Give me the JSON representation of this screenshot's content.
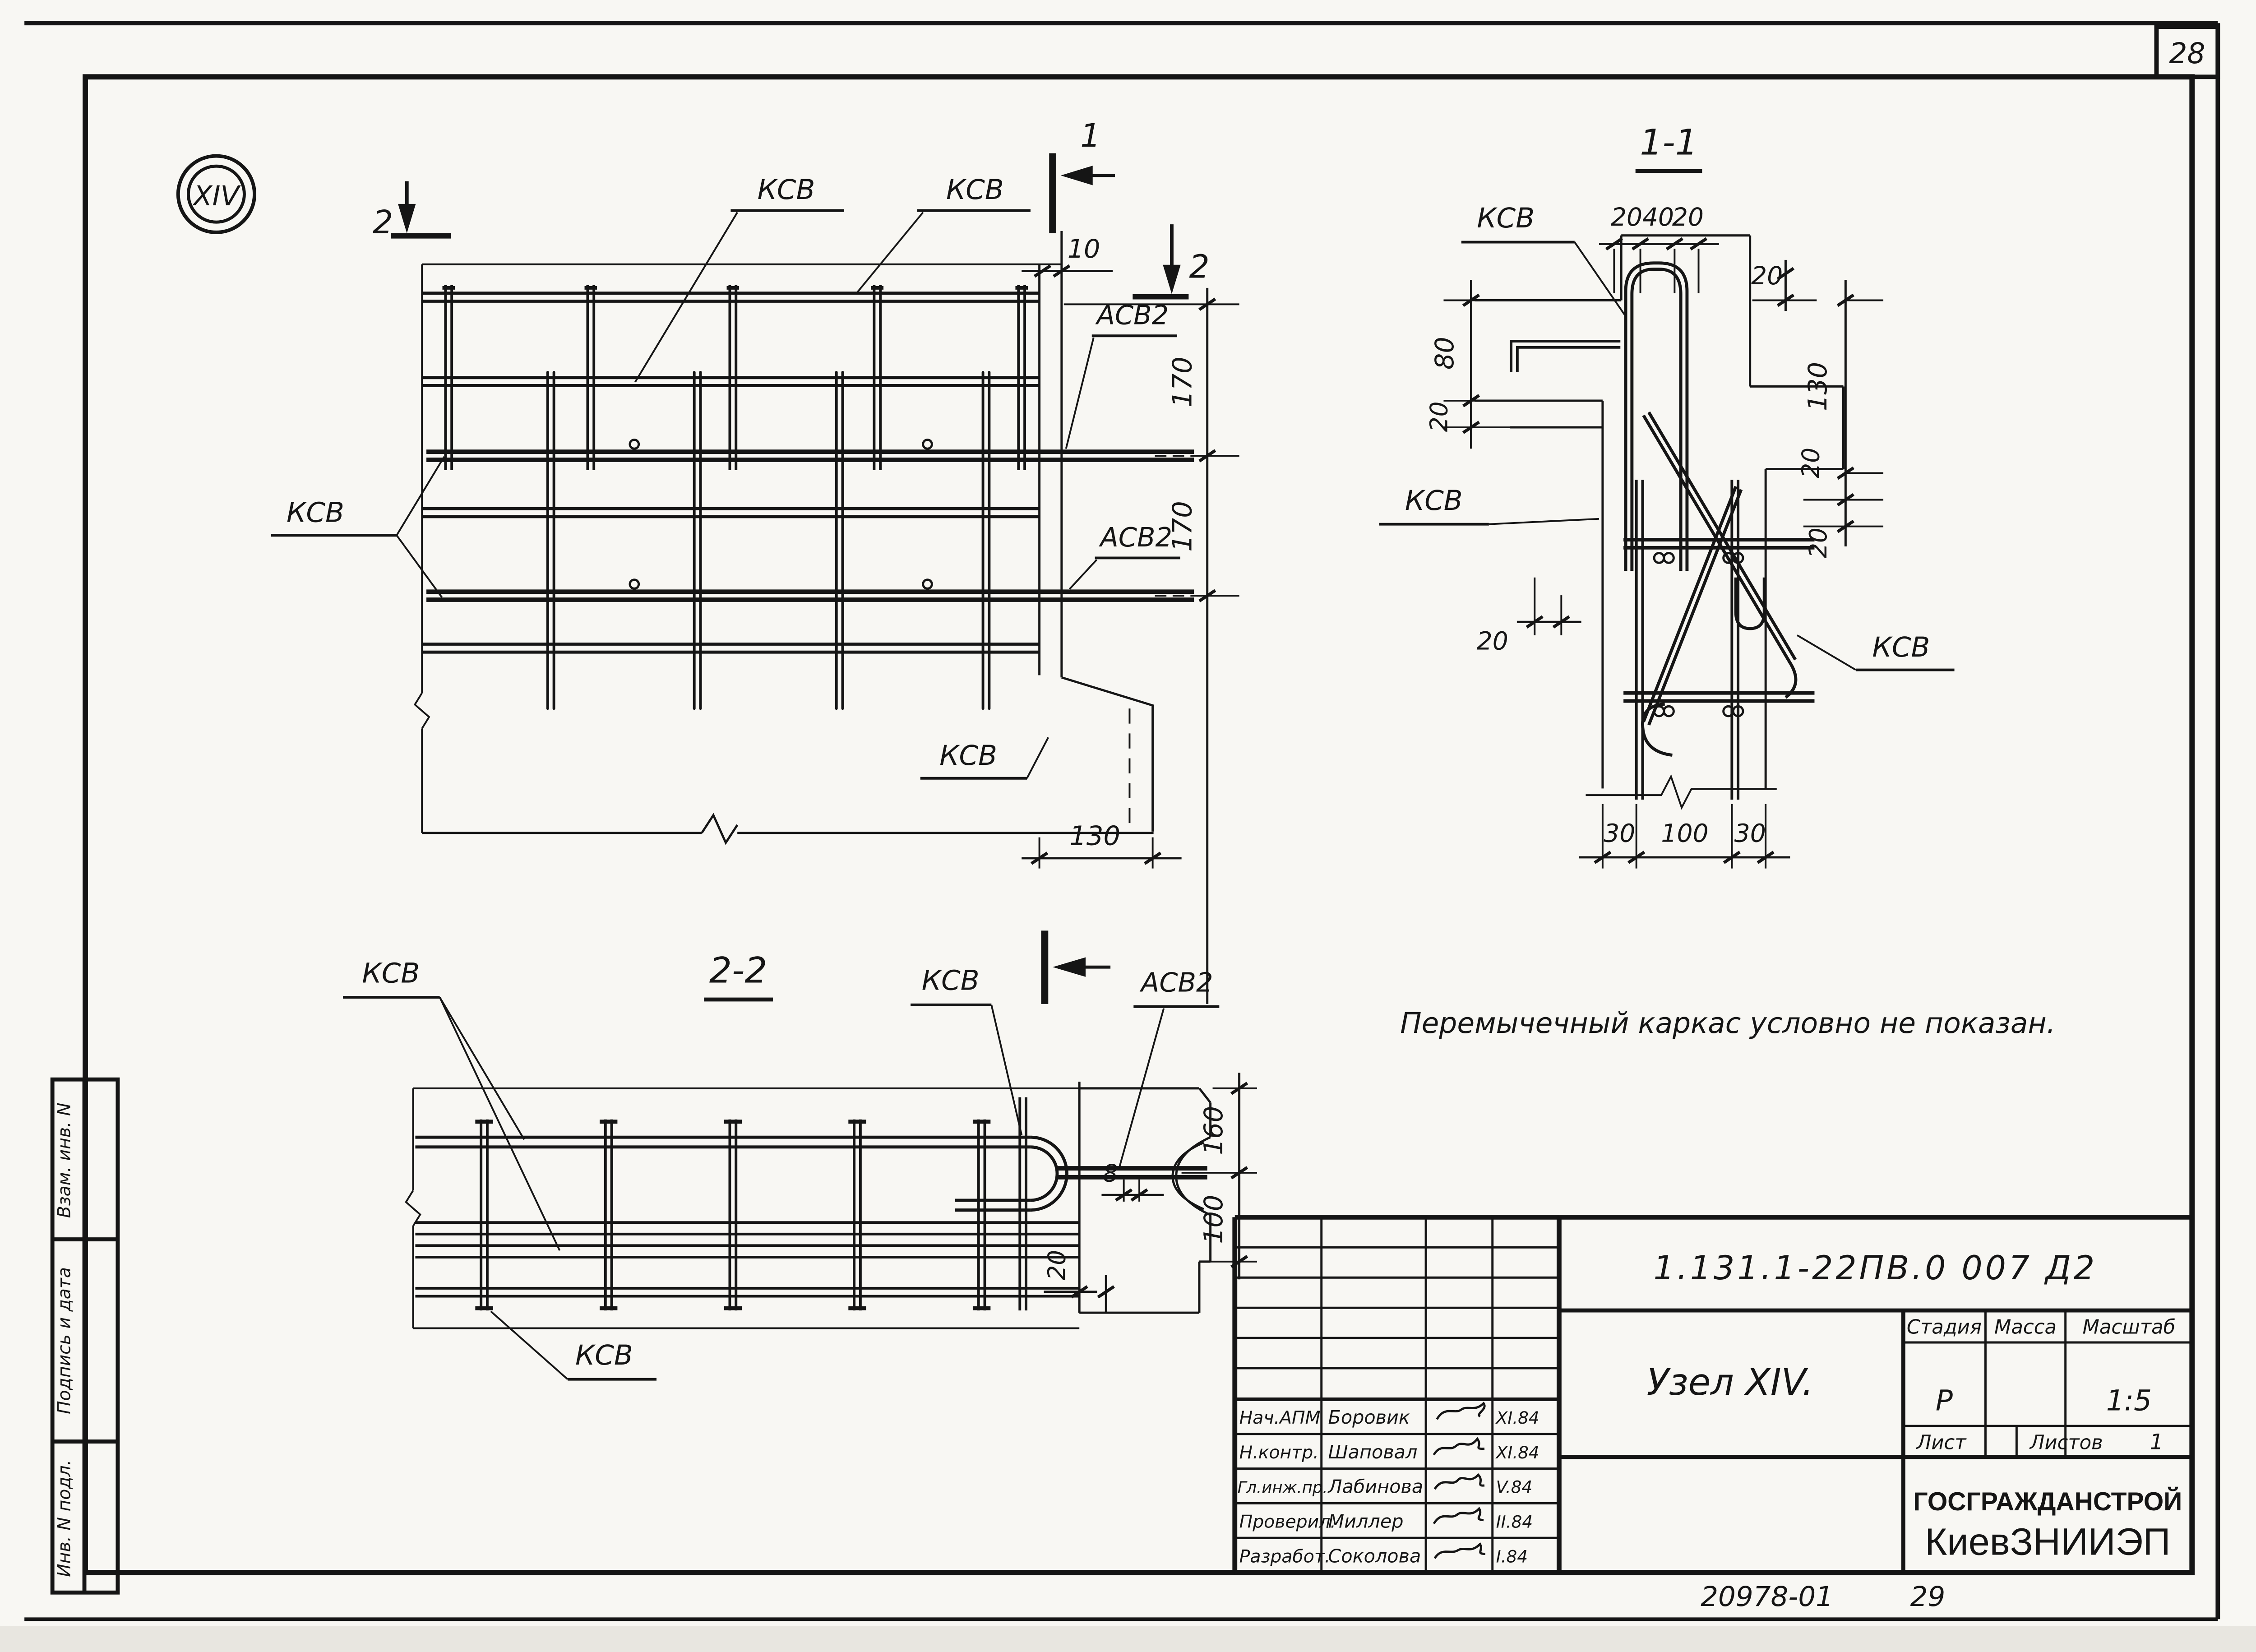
{
  "sheet": {
    "page_top": "28",
    "footer_doc": "20978-01",
    "footer_page": "29",
    "node_marker": "XIV",
    "note": "Перемычечный каркас условно не показан."
  },
  "labels": {
    "kcb": "КСВ",
    "acb2": "АСВ2"
  },
  "sections": {
    "s1": "1",
    "s2": "2",
    "t11": "1-1",
    "t22": "2-2"
  },
  "dims": {
    "d8": "8",
    "d10": "10",
    "d20": "20",
    "d30": "30",
    "d40": "40",
    "d80": "80",
    "d100": "100",
    "d130": "130",
    "d160": "160",
    "d170": "170"
  },
  "titleblock": {
    "doc_number": "1.131.1-22ПВ.0  007  Д2",
    "title": "Узел  XIV.",
    "stage_label": "Стадия",
    "mass_label": "Масса",
    "scale_label": "Масштаб",
    "stage_value": "Р",
    "mass_value": "",
    "scale_value": "1:5",
    "sheet_label": "Лист",
    "sheets_label": "Листов",
    "sheets_value": "1",
    "org_line1": "ГОСГРАЖДАНСТРОЙ",
    "org_line2": "КиевЗНИИЭП",
    "staff": [
      {
        "role": "Нач.АПМ",
        "name": "Боровик",
        "date": "XI.84"
      },
      {
        "role": "Н.контр.",
        "name": "Шаповал",
        "date": "XI.84"
      },
      {
        "role": "Гл.инж.пр.",
        "name": "Лабинова",
        "date": "V.84"
      },
      {
        "role": "Проверил.",
        "name": "Миллер",
        "date": "II.84"
      },
      {
        "role": "Разработ.",
        "name": "Соколова",
        "date": "I.84"
      }
    ]
  },
  "sidebar": {
    "cell1": "Взам. инв. N",
    "cell2": "Подпись и дата",
    "cell3": "Инв. N подл."
  }
}
